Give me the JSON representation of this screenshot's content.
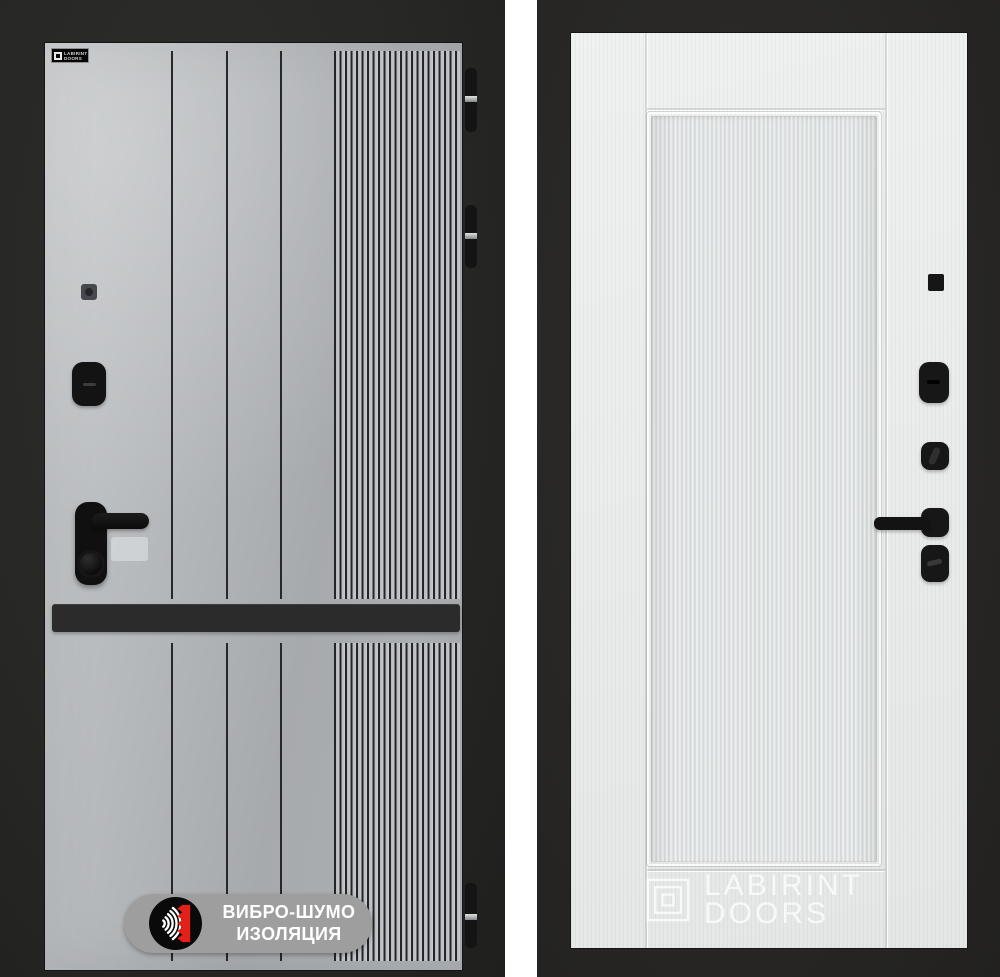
{
  "brand": "LABIRINT DOORS",
  "left_door": {
    "view": "exterior gray panel",
    "logo_plate": {
      "line1": "LABIRINT",
      "line2": "DOORS"
    },
    "badge": {
      "line1": "ВИБРО-ШУМО",
      "line2": "ИЗОЛЯЦИЯ",
      "icon": "sound-wave-insulation-icon",
      "pill_color": "#9e9e9e",
      "circle_color": "#0a0a0a",
      "accent_red": "#e32119",
      "text_color": "#ffffff"
    },
    "panel_color": "#aeb1b4",
    "frame_color": "#272725",
    "accent_strip_color": "#2b2b2b",
    "hardware_color": "#131313",
    "hinge_count": 3
  },
  "right_door": {
    "view": "interior white panel",
    "watermark": {
      "line1": "LABIRINT",
      "line2": "DOORS",
      "icon": "labirint-maze-logo"
    },
    "panel_color": "#e9eceb",
    "frame_color": "#282725",
    "hardware_color": "#171717"
  }
}
